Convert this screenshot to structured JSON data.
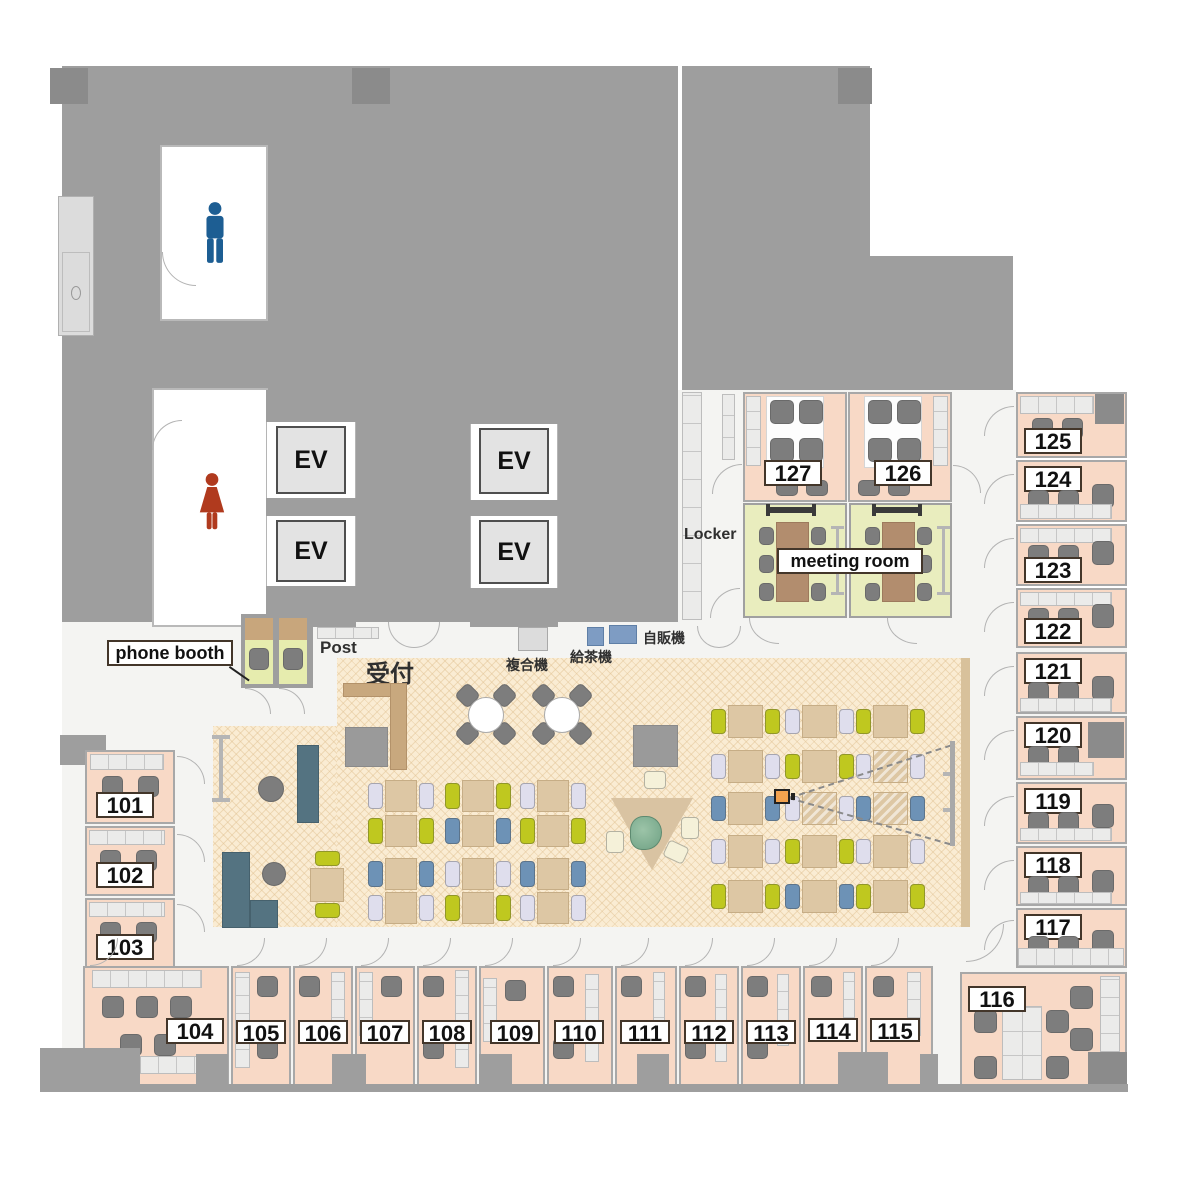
{
  "labels": {
    "phone_booth": "phone booth",
    "post": "Post",
    "reception": "受付",
    "copier": "複合機",
    "tea_machine": "給茶機",
    "vending_machine": "自販機",
    "locker": "Locker",
    "meeting_room": "meeting room",
    "elevator": "EV"
  },
  "rooms": {
    "r101": "101",
    "r102": "102",
    "r103": "103",
    "r104": "104",
    "r105": "105",
    "r106": "106",
    "r107": "107",
    "r108": "108",
    "r109": "109",
    "r110": "110",
    "r111": "111",
    "r112": "112",
    "r113": "113",
    "r114": "114",
    "r115": "115",
    "r116": "116",
    "r117": "117",
    "r118": "118",
    "r119": "119",
    "r120": "120",
    "r121": "121",
    "r122": "122",
    "r123": "123",
    "r124": "124",
    "r125": "125",
    "r126": "126",
    "r127": "127"
  },
  "colors": {
    "wall_gray": "#9e9e9e",
    "office_pink": "#f8d9c6",
    "meeting_green": "#e9edbe",
    "workspace_beige": "#faecd3",
    "corridor": "#f4f4f2",
    "male_blue": "#1d5e93",
    "female_red": "#b03a1e",
    "sofa_teal": "#547381",
    "chair_yellow": "#bfc81f",
    "chair_blue": "#6d92b6",
    "chair_lavender": "#dfdeed",
    "projector_orange": "#f2a24f"
  }
}
